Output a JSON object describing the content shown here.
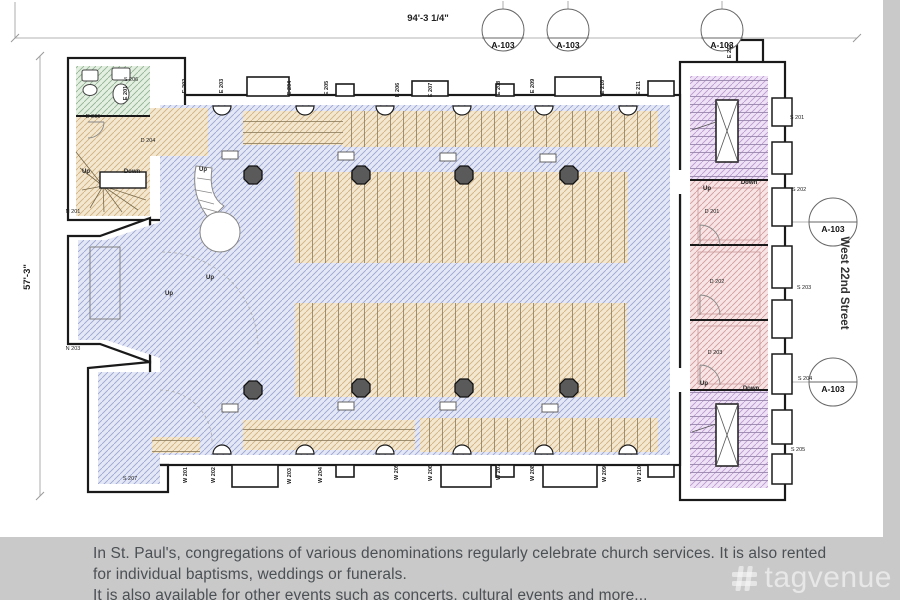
{
  "colors": {
    "page_bg": "#c9c9c9",
    "paper": "#ffffff",
    "wall": "#1a1a1a",
    "hatch_blue_bg": "#e4e7f5",
    "hatch_blue_line": "#99a3d1",
    "hatch_tan_bg": "#f3e7cf",
    "hatch_tan_line": "#cfae7e",
    "hatch_pink_bg": "#f8e4e4",
    "hatch_pink_line": "#d09a9a",
    "hatch_purple_bg": "#f0e2f6",
    "hatch_purple_line": "#b897cf",
    "hatch_green_bg": "#e3efe1",
    "hatch_green_line": "#90b090",
    "column": "#5a5a5a",
    "dim_line": "#9a9a9a",
    "label_text": "#222222",
    "caption_text": "#4b5054",
    "watermark": "rgba(255,255,255,0.55)"
  },
  "caption": {
    "lines": [
      "In St. Paul's, congregations of various denominations regularly celebrate church services. It is also rented",
      "for individual baptisms, weddings or funerals.",
      "It is also available for other events such as concerts, cultural events and more..."
    ]
  },
  "watermark": {
    "brand": "tagvenue"
  },
  "plan": {
    "dimension_top": "94'-3 1/4\"",
    "dimension_left": "57'-3\"",
    "street": "West 22nd Street",
    "sheet_markers": [
      {
        "label": "A-103",
        "cx": 503,
        "cy": 30,
        "r": 21,
        "chord": 8,
        "stub": "up"
      },
      {
        "label": "A-103",
        "cx": 568,
        "cy": 30,
        "r": 21,
        "chord": 8,
        "stub": "up"
      },
      {
        "label": "A-103",
        "cx": 722,
        "cy": 30,
        "r": 21,
        "chord": 8,
        "stub": "up"
      },
      {
        "label": "A-103",
        "cx": 833,
        "cy": 222,
        "r": 24,
        "chord": 0,
        "stub": "left"
      },
      {
        "label": "A-103",
        "cx": 833,
        "cy": 382,
        "r": 24,
        "chord": 0,
        "stub": "left"
      }
    ],
    "columns": [
      [
        253,
        175
      ],
      [
        361,
        175
      ],
      [
        464,
        175
      ],
      [
        569,
        175
      ],
      [
        253,
        390
      ],
      [
        361,
        388
      ],
      [
        464,
        388
      ],
      [
        569,
        388
      ]
    ],
    "labels": [
      {
        "t": "E 201",
        "x": 127,
        "y": 93,
        "k": "wall"
      },
      {
        "t": "E 202",
        "x": 186,
        "y": 86,
        "k": "wall"
      },
      {
        "t": "E 203",
        "x": 223,
        "y": 86,
        "k": "wall"
      },
      {
        "t": "E 204",
        "x": 291,
        "y": 88,
        "k": "wall"
      },
      {
        "t": "E 205",
        "x": 328,
        "y": 88,
        "k": "wall"
      },
      {
        "t": "E 206",
        "x": 399,
        "y": 90,
        "k": "wall"
      },
      {
        "t": "E 207",
        "x": 432,
        "y": 90,
        "k": "wall"
      },
      {
        "t": "E 208",
        "x": 500,
        "y": 88,
        "k": "wall"
      },
      {
        "t": "E 209",
        "x": 534,
        "y": 86,
        "k": "wall"
      },
      {
        "t": "E 210",
        "x": 604,
        "y": 87,
        "k": "wall"
      },
      {
        "t": "E 211",
        "x": 640,
        "y": 88,
        "k": "wall"
      },
      {
        "t": "E 212",
        "x": 731,
        "y": 51,
        "k": "wall"
      },
      {
        "t": "W 201",
        "x": 187,
        "y": 475,
        "k": "wall"
      },
      {
        "t": "W 202",
        "x": 215,
        "y": 475,
        "k": "wall"
      },
      {
        "t": "W 203",
        "x": 291,
        "y": 476,
        "k": "wall"
      },
      {
        "t": "W 204",
        "x": 322,
        "y": 475,
        "k": "wall"
      },
      {
        "t": "W 205",
        "x": 398,
        "y": 472,
        "k": "wall"
      },
      {
        "t": "W 206",
        "x": 432,
        "y": 473,
        "k": "wall"
      },
      {
        "t": "W 207",
        "x": 500,
        "y": 472,
        "k": "wall"
      },
      {
        "t": "W 208",
        "x": 534,
        "y": 473,
        "k": "wall"
      },
      {
        "t": "W 209",
        "x": 606,
        "y": 474,
        "k": "wall"
      },
      {
        "t": "W 210",
        "x": 641,
        "y": 474,
        "k": "wall"
      },
      {
        "t": "S 206",
        "x": 131,
        "y": 81,
        "k": "room"
      },
      {
        "t": "D 206",
        "x": 93,
        "y": 118,
        "k": "room"
      },
      {
        "t": "D 204",
        "x": 148,
        "y": 142,
        "k": "room"
      },
      {
        "t": "N 201",
        "x": 73,
        "y": 213,
        "k": "room"
      },
      {
        "t": "N 203",
        "x": 73,
        "y": 350,
        "k": "room"
      },
      {
        "t": "S 207",
        "x": 130,
        "y": 480,
        "k": "room"
      },
      {
        "t": "S 201",
        "x": 797,
        "y": 119,
        "k": "room"
      },
      {
        "t": "S 202",
        "x": 799,
        "y": 191,
        "k": "room"
      },
      {
        "t": "S 203",
        "x": 804,
        "y": 289,
        "k": "room"
      },
      {
        "t": "S 204",
        "x": 805,
        "y": 380,
        "k": "room"
      },
      {
        "t": "S 205",
        "x": 798,
        "y": 451,
        "k": "room"
      },
      {
        "t": "D 201",
        "x": 712,
        "y": 213,
        "k": "room"
      },
      {
        "t": "D 202",
        "x": 717,
        "y": 283,
        "k": "room"
      },
      {
        "t": "D 203",
        "x": 715,
        "y": 354,
        "k": "room"
      },
      {
        "t": "Up",
        "x": 86,
        "y": 173,
        "k": "dir"
      },
      {
        "t": "Down",
        "x": 132,
        "y": 173,
        "k": "dir"
      },
      {
        "t": "Up",
        "x": 203,
        "y": 171,
        "k": "dir"
      },
      {
        "t": "Up",
        "x": 210,
        "y": 279,
        "k": "dir"
      },
      {
        "t": "Up",
        "x": 169,
        "y": 295,
        "k": "dir"
      },
      {
        "t": "Up",
        "x": 707,
        "y": 190,
        "k": "dir"
      },
      {
        "t": "Down",
        "x": 749,
        "y": 184,
        "k": "dir"
      },
      {
        "t": "Up",
        "x": 704,
        "y": 385,
        "k": "dir"
      },
      {
        "t": "Down",
        "x": 751,
        "y": 390,
        "k": "dir"
      }
    ]
  }
}
